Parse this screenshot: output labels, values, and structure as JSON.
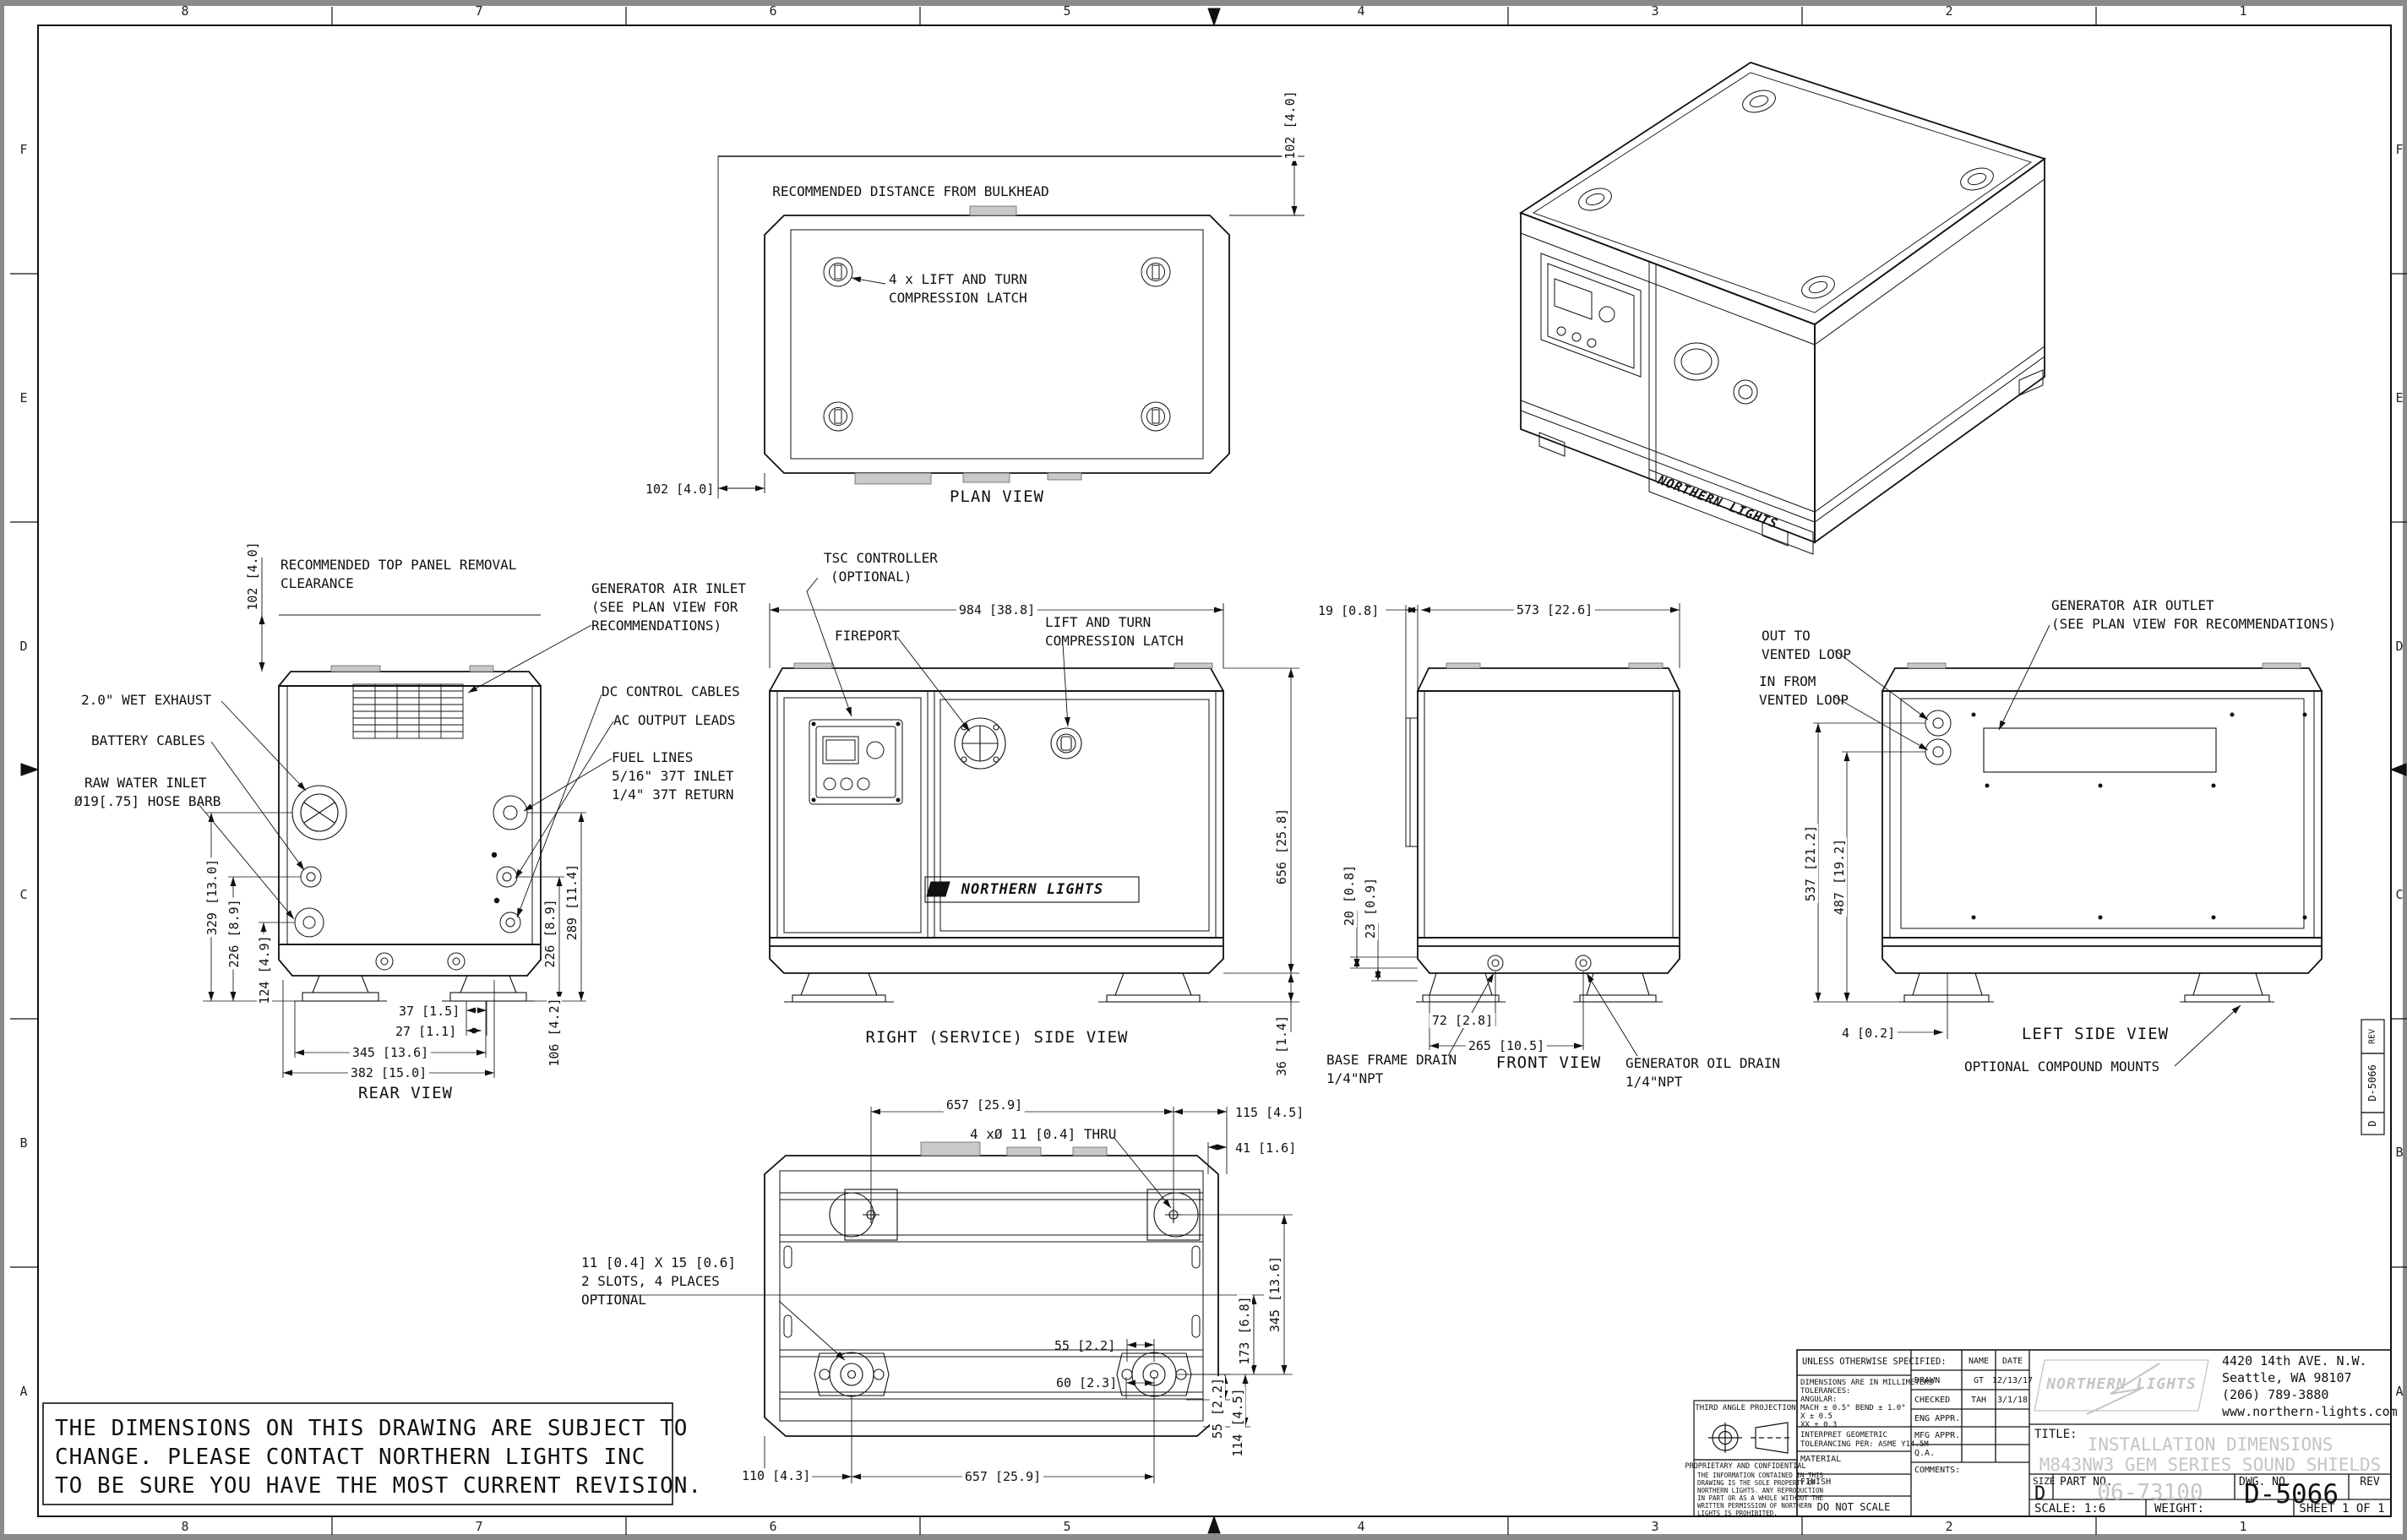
{
  "sheet": {
    "zones_top": [
      "8",
      "7",
      "6",
      "5",
      "4",
      "3",
      "2",
      "1"
    ],
    "zones_bottom": [
      "8",
      "7",
      "6",
      "5",
      "4",
      "3",
      "2",
      "1"
    ],
    "zones_left": [
      "F",
      "E",
      "D",
      "C",
      "B",
      "A"
    ],
    "zones_right": [
      "F",
      "E",
      "D",
      "C",
      "B",
      "A"
    ],
    "edge_block": {
      "rev_label": "REV",
      "dwg_no": "D-5066",
      "size": "D"
    }
  },
  "notes": {
    "rev_line1": "THE DIMENSIONS ON THIS DRAWING ARE SUBJECT TO",
    "rev_line2": "CHANGE. PLEASE CONTACT NORTHERN LIGHTS INC",
    "rev_line3": "TO BE SURE YOU HAVE THE MOST CURRENT REVISION."
  },
  "views": {
    "plan": {
      "title": "PLAN VIEW",
      "bulkhead_label": "RECOMMENDED DISTANCE FROM BULKHEAD",
      "dim_top": "102 [4.0]",
      "dim_left": "102 [4.0]",
      "latch_line1": "4 x LIFT AND TURN",
      "latch_line2": "COMPRESSION LATCH"
    },
    "iso": {
      "logo": "NORTHERN LIGHTS"
    },
    "rear": {
      "title": "REAR VIEW",
      "dim_clearance": "102 [4.0]",
      "clearance_line1": "RECOMMENDED TOP PANEL REMOVAL",
      "clearance_line2": "CLEARANCE",
      "air_inlet_line1": "GENERATOR AIR INLET",
      "air_inlet_line2": "(SEE PLAN VIEW FOR",
      "air_inlet_line3": "RECOMMENDATIONS)",
      "wet_exhaust": "2.0\" WET EXHAUST",
      "battery": "BATTERY CABLES",
      "raw_water_line1": "RAW WATER INLET",
      "raw_water_line2": "Ø19[.75] HOSE BARB",
      "dc": "DC CONTROL CABLES",
      "ac": "AC OUTPUT LEADS",
      "fuel_line1": "FUEL LINES",
      "fuel_line2": "5/16\" 37T INLET",
      "fuel_line3": "1/4\" 37T RETURN",
      "dim_329": "329 [13.0]",
      "dim_226l": "226 [8.9]",
      "dim_124": "124 [4.9]",
      "dim_37": "37 [1.5]",
      "dim_27": "27 [1.1]",
      "dim_345": "345 [13.6]",
      "dim_382": "382 [15.0]",
      "dim_226r": "226 [8.9]",
      "dim_289": "289 [11.4]",
      "dim_106": "106 [4.2]"
    },
    "right_side": {
      "title": "RIGHT (SERVICE) SIDE VIEW",
      "tsc_line1": "TSC CONTROLLER",
      "tsc_line2": "(OPTIONAL)",
      "fireport": "FIREPORT",
      "dim_width": "984 [38.8]",
      "latch_line1": "LIFT AND TURN",
      "latch_line2": "COMPRESSION LATCH",
      "dim_height": "656 [25.8]",
      "dim_foot": "36 [1.4]",
      "logo": "NORTHERN LIGHTS"
    },
    "front": {
      "title": "FRONT VIEW",
      "dim_19": "19 [0.8]",
      "dim_573": "573 [22.6]",
      "dim_20": "20 [0.8]",
      "dim_23": "23 [0.9]",
      "dim_72": "72 [2.8]",
      "dim_265": "265 [10.5]",
      "base_drain_line1": "BASE FRAME DRAIN",
      "base_drain_line2": "1/4\"NPT",
      "oil_drain_line1": "GENERATOR OIL DRAIN",
      "oil_drain_line2": "1/4\"NPT"
    },
    "left_side": {
      "title": "LEFT SIDE VIEW",
      "air_outlet_line1": "GENERATOR AIR OUTLET",
      "air_outlet_line2": "(SEE PLAN VIEW FOR RECOMMENDATIONS)",
      "out_line1": "OUT TO",
      "out_line2": "VENTED LOOP",
      "in_line1": "IN FROM",
      "in_line2": "VENTED LOOP",
      "dim_537": "537 [21.2]",
      "dim_487": "487 [19.2]",
      "dim_4": "4 [0.2]",
      "mounts": "OPTIONAL COMPOUND MOUNTS"
    },
    "bottom": {
      "dim_657_top": "657 [25.9]",
      "dim_115": "115 [4.5]",
      "dim_41": "41 [1.6]",
      "thru": "4 xØ 11 [0.4] THRU",
      "slots_line1": "11 [0.4] X 15 [0.6]",
      "slots_line2": "2 SLOTS, 4 PLACES",
      "slots_line3": "OPTIONAL",
      "dim_345": "345 [13.6]",
      "dim_173": "173 [6.8]",
      "dim_55a": "55 [2.2]",
      "dim_60": "60 [2.3]",
      "dim_55b": "55 [2.2]",
      "dim_114": "114 [4.5]",
      "dim_110": "110 [4.3]",
      "dim_657_bottom": "657 [25.9]"
    }
  },
  "projection": {
    "label": "THIRD ANGLE PROJECTION",
    "prop_title": "PROPRIETARY AND CONFIDENTIAL",
    "prop_body": [
      "THE INFORMATION CONTAINED IN THIS",
      "DRAWING IS THE SOLE PROPERTY OF",
      "NORTHERN LIGHTS.  ANY REPRODUCTION",
      "IN PART OR AS A WHOLE WITHOUT THE",
      "WRITTEN PERMISSION OF NORTHERN",
      "LIGHTS IS PROHIBITED."
    ]
  },
  "title_block": {
    "unless": "UNLESS OTHERWISE SPECIFIED:",
    "dims_mm": "DIMENSIONS ARE IN MILLIMETERS",
    "tol": "TOLERANCES:",
    "ang": "ANGULAR:",
    "mach": "MACH ± 0.5°  BEND ± 1.0°",
    "x_tol": "X  ± 0.5",
    "xx_tol": "XX ± 0.3",
    "interpret1": "INTERPRET GEOMETRIC",
    "interpret2": "TOLERANCING PER: ASME Y14.5M",
    "material": "MATERIAL",
    "finish": "FINISH",
    "do_not_scale": "DO NOT SCALE",
    "name_h": "NAME",
    "date_h": "DATE",
    "drawn": "DRAWN",
    "drawn_name": "GT",
    "drawn_date": "12/13/17",
    "checked": "CHECKED",
    "checked_name": "TAH",
    "checked_date": "3/1/18",
    "eng": "ENG APPR.",
    "mfg": "MFG APPR.",
    "qa": "Q.A.",
    "comments": "COMMENTS:",
    "company": "NORTHERN LIGHTS",
    "addr1": "4420 14th AVE. N.W.",
    "addr2": "Seattle, WA 98107",
    "addr3": "(206) 789-3880",
    "addr4": "www.northern-lights.com",
    "title_label": "TITLE:",
    "title1": "INSTALLATION DIMENSIONS",
    "title2": "M843NW3 GEM SERIES SOUND SHIELDS",
    "size_label": "SIZE",
    "size": "D",
    "part_label": "PART NO.",
    "part_no": "06-73100",
    "dwg_label": "DWG.  NO.",
    "dwg_no": "D-5066",
    "rev_label": "REV",
    "scale": "SCALE: 1:6",
    "weight": "WEIGHT:",
    "sheet": "SHEET 1 OF 1"
  },
  "colors": {
    "line": "#111111",
    "watermark": "#c4c4c4",
    "tab_fill": "#c9c9c9",
    "edge": "#8a8a8a"
  }
}
